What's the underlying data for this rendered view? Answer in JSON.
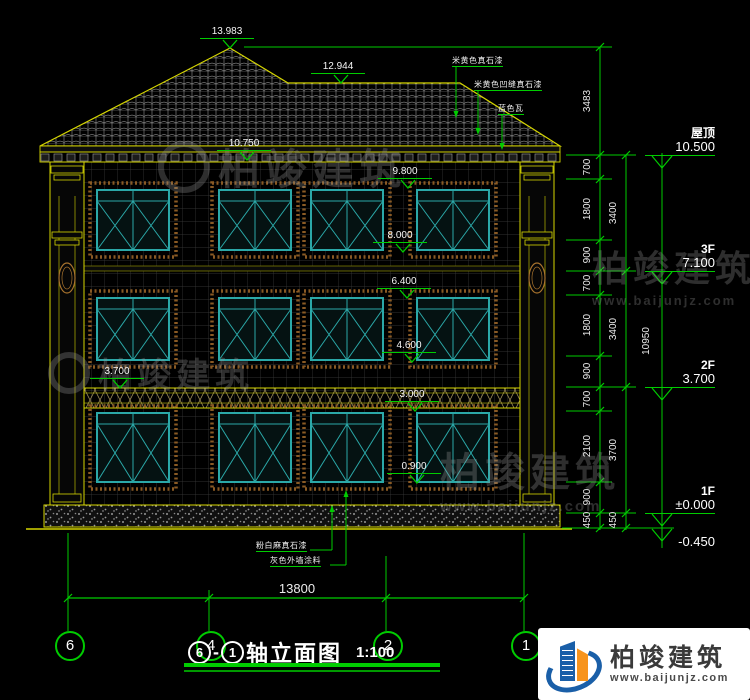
{
  "title": {
    "axis_from": "6",
    "axis_to": "1",
    "text": "轴立面图",
    "scale": "1:100"
  },
  "markers": {
    "m13983": "13.983",
    "m12944": "12.944",
    "m10750": "10.750",
    "m9800": "9.800",
    "m8000": "8.000",
    "m6400": "6.400",
    "m4600": "4.600",
    "m3700": "3.700",
    "m3000": "3.000",
    "m0900": "0.900"
  },
  "levels": {
    "roof_label": "屋顶",
    "roof_value": "10.500",
    "f3_label": "3F",
    "f3_value": "7.100",
    "f2_label": "2F",
    "f2_value": "3.700",
    "f1_label": "1F",
    "f1_value": "±0.000",
    "ground_value": "-0.450"
  },
  "dims": {
    "right_inner": [
      "3483",
      "700",
      "1800",
      "900",
      "700",
      "1800",
      "900",
      "700",
      "2100",
      "900",
      "450"
    ],
    "right_middle": [
      "3400",
      "3400",
      "3700",
      "450"
    ],
    "right_total": "10950",
    "bottom_total": "13800"
  },
  "axes": [
    "6",
    "4",
    "2",
    "1"
  ],
  "materials": {
    "roof1": "米黄色真石漆",
    "roof2": "米黄色凹缝真石漆",
    "roof3": "蓝色瓦",
    "base1": "粉白麻真石漆",
    "base2": "灰色外墙涂料"
  },
  "watermark": {
    "name": "柏竣建筑",
    "site": "www.baijunjz.com"
  },
  "logo": {
    "name": "柏竣建筑",
    "site": "www.baijunjz.com"
  },
  "colors": {
    "line_green": "#00cc00",
    "outline_yellow": "#d6d600",
    "window_teal": "#2ba8a8"
  }
}
